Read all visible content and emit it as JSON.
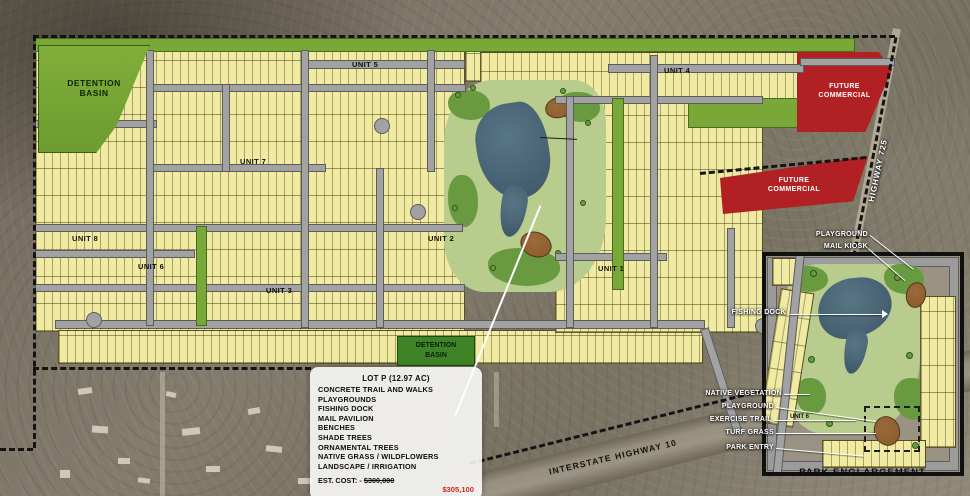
{
  "map": {
    "units": {
      "u1": "UNIT 1",
      "u2": "UNIT 2",
      "u3": "UNIT 3",
      "u4": "UNIT 4",
      "u5": "UNIT 5",
      "u6": "UNIT 6",
      "u7": "UNIT 7",
      "u8": "UNIT 8"
    },
    "detention_line1": "DETENTION",
    "detention_line2": "BASIN",
    "future_commercial_line1": "FUTURE",
    "future_commercial_line2": "COMMERCIAL",
    "highway_725": "HIGHWAY 725",
    "interstate_10": "INTERSTATE HIGHWAY 10"
  },
  "info_box": {
    "title": "LOT P (12.97 AC)",
    "items": [
      "CONCRETE TRAIL AND WALKS",
      "PLAYGROUNDS",
      "FISHING DOCK",
      "MAIL PAVILION",
      "BENCHES",
      "SHADE TREES",
      "ORNAMENTAL TREES",
      "NATIVE GRASS / WILDFLOWERS",
      "LANDSCAPE / IRRIGATION"
    ],
    "cost_label": "EST. COST: -",
    "cost_original": "$300,000",
    "cost_revised": "$305,100"
  },
  "park_inset": {
    "title": "PARK ENGLARGEMENT",
    "unit_label": "UNIT 6",
    "callouts": {
      "playground_top": "PLAYGROUND",
      "mail_kiosk": "MAIL KIOSK",
      "fishing_dock": "FISHING DOCK",
      "native_vegetation": "NATIVE VEGETATION",
      "playground_left": "PLAYGROUND",
      "exercise_trail": "EXERCISE TRAIL",
      "turf_grass": "TURF GRASS",
      "park_entry": "PARK ENTRY"
    }
  },
  "colors": {
    "lot_yellow": "#f0eaa3",
    "road_gray": "#a2a2a2",
    "road_edge": "#5c5c5c",
    "green_space": "#79a838",
    "park_green": "#b8cd8d",
    "veg_green": "#6a9a40",
    "pond_blue": "#3c5767",
    "commercial_red": "#b12023",
    "playground_brown": "#8a5a2e",
    "basin_green": "#3e8426",
    "boundary": "#141414",
    "highway_tan": "#b3ab96",
    "interstate_gray": "#8e8877",
    "cost_red": "#cf2b24"
  }
}
